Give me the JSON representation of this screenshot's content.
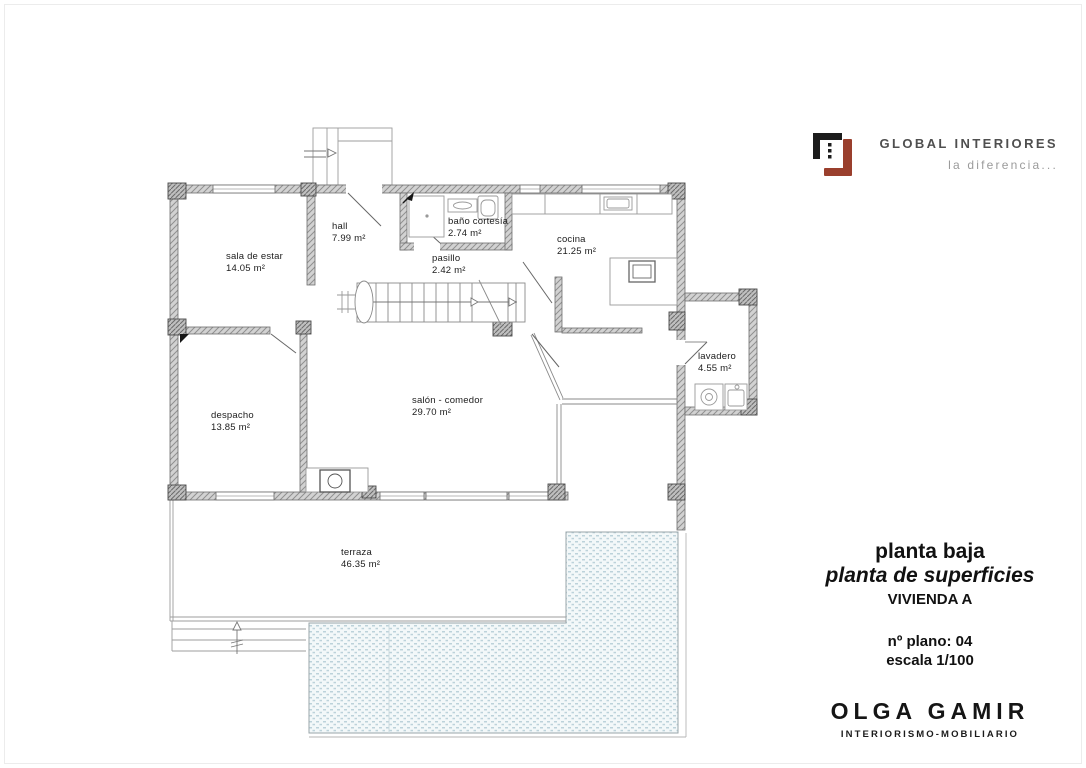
{
  "brand": {
    "name": "GLOBAL INTERIORES",
    "tagline": "la diferencia...",
    "colors": {
      "logo_black": "#1c1c1c",
      "logo_red": "#9a3f2d"
    }
  },
  "title_block": {
    "floor": "planta baja",
    "plan_type": "planta de superficies",
    "dwelling": "VIVIENDA A",
    "plan_number": "nº plano: 04",
    "scale": "escala 1/100"
  },
  "studio": {
    "name": "OLGA GAMIR",
    "subtitle": "INTERIORISMO-MOBILIARIO"
  },
  "rooms": [
    {
      "name": "sala de estar",
      "area": "14.05 m²"
    },
    {
      "name": "hall",
      "area": "7.99 m²"
    },
    {
      "name": "baño cortesía",
      "area": "2.74 m²"
    },
    {
      "name": "cocina",
      "area": "21.25 m²"
    },
    {
      "name": "pasillo",
      "area": "2.42 m²"
    },
    {
      "name": "despacho",
      "area": "13.85 m²"
    },
    {
      "name": "salón - comedor",
      "area": "29.70 m²"
    },
    {
      "name": "lavadero",
      "area": "4.55 m²"
    },
    {
      "name": "terraza",
      "area": "46.35 m²"
    }
  ],
  "drawing_colors": {
    "wall_hatch": "#d2d2d2",
    "column_hatch": "#bfbfbf",
    "pool_water": "#f3f8f9",
    "pool_dots": "#bcd2da"
  }
}
